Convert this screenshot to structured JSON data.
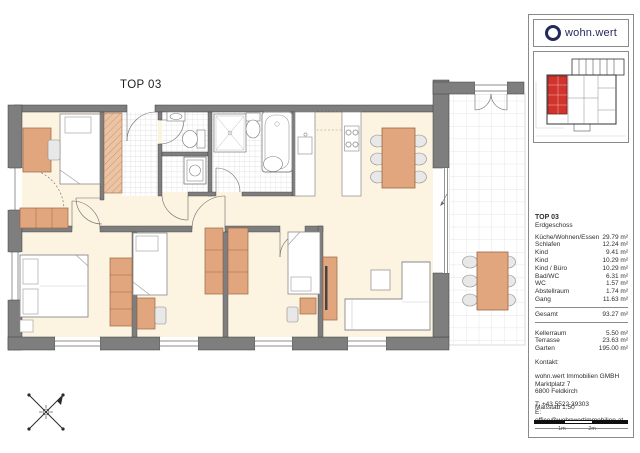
{
  "plan": {
    "title": "TOP 03"
  },
  "logo": {
    "text": "wohn.wert"
  },
  "colors": {
    "accent_navy": "#242a5c",
    "wall_gray": "#7e7e7e",
    "floor_cream": "#fcf3e0",
    "furniture_tan": "#e1a67e",
    "highlight_red": "#d0342c"
  },
  "unit_info": {
    "unit": "TOP 03",
    "floor": "Erdgeschoss",
    "rooms": [
      {
        "label": "Küche/Wohnen/Essen",
        "area": "29.79 m²"
      },
      {
        "label": "Schlafen",
        "area": "12.24 m²"
      },
      {
        "label": "Kind",
        "area": "9.41 m²"
      },
      {
        "label": "Kind",
        "area": "10.29 m²"
      },
      {
        "label": "Kind / Büro",
        "area": "10.29 m²"
      },
      {
        "label": "Bad/WC",
        "area": "6.31 m²"
      },
      {
        "label": "WC",
        "area": "1.57 m²"
      },
      {
        "label": "Abstellraum",
        "area": "1.74 m²"
      },
      {
        "label": "Gang",
        "area": "11.63 m²"
      }
    ],
    "total_label": "Gesamt",
    "total_area": "93.27 m²",
    "extras": [
      {
        "label": "Kellerraum",
        "area": "5.50 m²"
      },
      {
        "label": "Terrasse",
        "area": "23.63 m²"
      },
      {
        "label": "Garten",
        "area": "195.00 m²"
      }
    ]
  },
  "contact": {
    "heading": "Kontakt:",
    "company": "wohn.wert Immobilien GMBH",
    "street": "Marktplatz 7",
    "city": "6800 Feldkirch",
    "phone": "T: +43 5522 39303",
    "email": "E: office@wohnwertimmobilien.at"
  },
  "scale": {
    "label": "Maßstab 1:50",
    "mark_1m": "1m",
    "mark_2m": "2m"
  }
}
